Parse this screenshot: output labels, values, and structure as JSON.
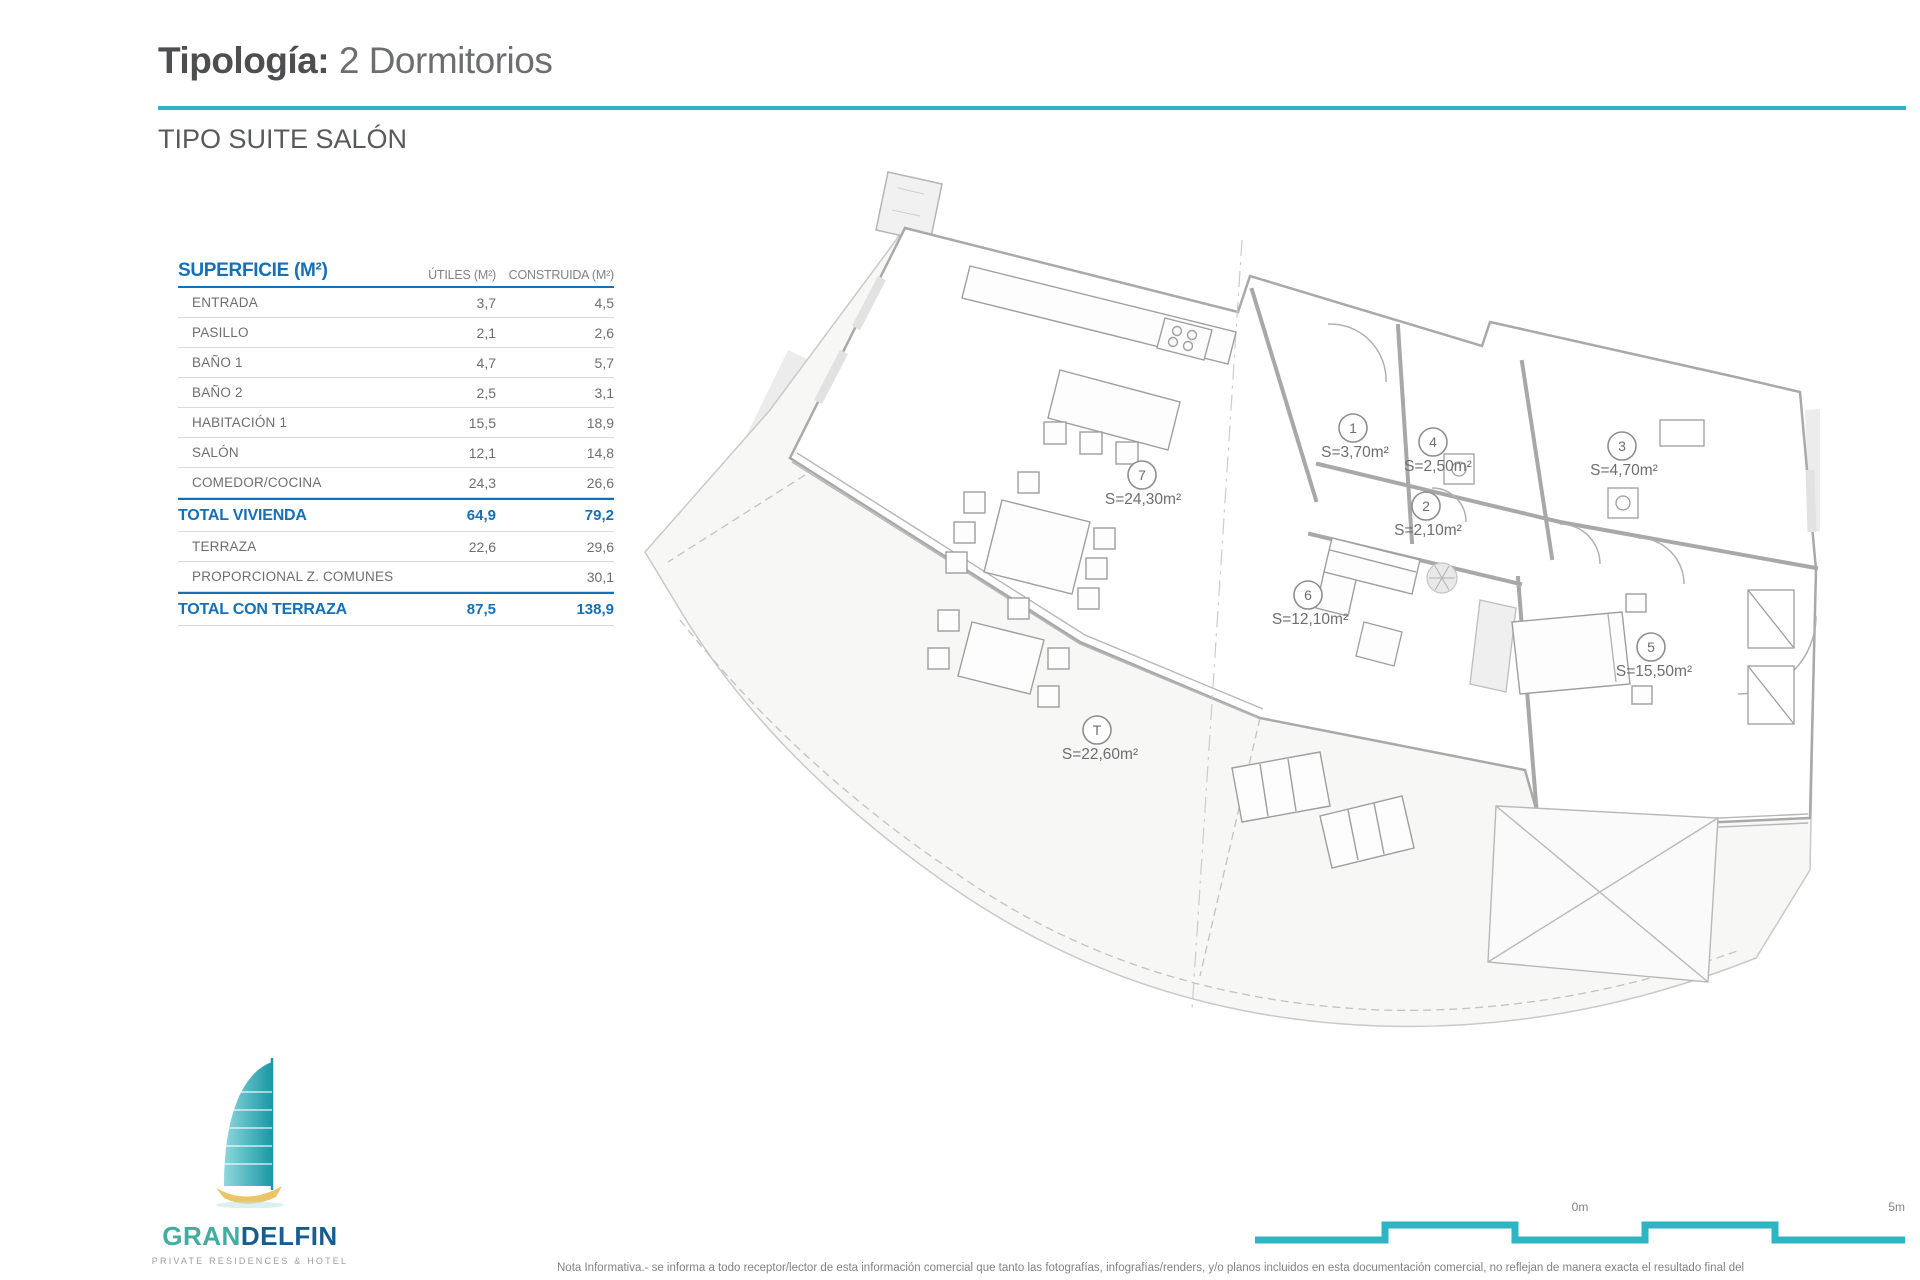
{
  "header": {
    "title_bold": "Tipología:",
    "title_light": " 2 Dormitorios",
    "subtitle": "TIPO SUITE SALÓN"
  },
  "table": {
    "title": "SUPERFICIE (M²)",
    "col_utiles": "ÚTILES (M²)",
    "col_construida": "CONSTRUIDA (M²)",
    "rows": [
      {
        "label": "ENTRADA",
        "utiles": "3,7",
        "construida": "4,5"
      },
      {
        "label": "PASILLO",
        "utiles": "2,1",
        "construida": "2,6"
      },
      {
        "label": "BAÑO 1",
        "utiles": "4,7",
        "construida": "5,7"
      },
      {
        "label": "BAÑO 2",
        "utiles": "2,5",
        "construida": "3,1"
      },
      {
        "label": "HABITACIÓN 1",
        "utiles": "15,5",
        "construida": "18,9"
      },
      {
        "label": "SALÓN",
        "utiles": "12,1",
        "construida": "14,8"
      },
      {
        "label": "COMEDOR/COCINA",
        "utiles": "24,3",
        "construida": "26,6"
      },
      {
        "label": "TOTAL VIVIENDA",
        "utiles": "64,9",
        "construida": "79,2"
      },
      {
        "label": "TERRAZA",
        "utiles": "22,6",
        "construida": "29,6"
      },
      {
        "label": "PROPORCIONAL Z. COMUNES",
        "utiles": "",
        "construida": "30,1"
      },
      {
        "label": "TOTAL CON TERRAZA",
        "utiles": "87,5",
        "construida": "138,9"
      }
    ]
  },
  "floorplan": {
    "rooms": [
      {
        "id": "7",
        "area": "S=24,30m²"
      },
      {
        "id": "1",
        "area": "S=3,70m²"
      },
      {
        "id": "4",
        "area": "S=2,50m²"
      },
      {
        "id": "3",
        "area": "S=4,70m²"
      },
      {
        "id": "2",
        "area": "S=2,10m²"
      },
      {
        "id": "6",
        "area": "S=12,10m²"
      },
      {
        "id": "5",
        "area": "S=15,50m²"
      },
      {
        "id": "T",
        "area": "S=22,60m²"
      }
    ]
  },
  "logo": {
    "brand_light": "GRAN",
    "brand_dark": "DELFIN",
    "tagline": "PRIVATE RESIDENCES & HOTEL"
  },
  "scalebar": {
    "zero": "0m",
    "five": "5m"
  },
  "footnote": "Nota Informativa.- se informa a todo receptor/lector de esta información comercial que tanto las fotografías, infografías/renders, y/o planos incluidos en esta documentación comercial, no reflejan de manera exacta el resultado final del",
  "colors": {
    "teal": "#2eb5c3",
    "blue": "#1470b8",
    "gray": "#6d6e71"
  }
}
